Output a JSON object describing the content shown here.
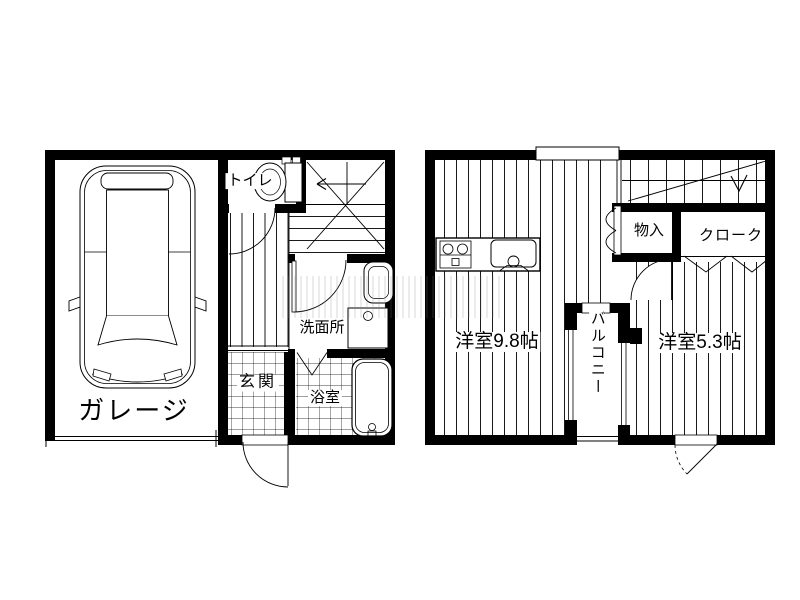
{
  "canvas": {
    "width": 800,
    "height": 600,
    "background": "#ffffff",
    "line_color": "#000000"
  },
  "floor1": {
    "rooms": {
      "garage": {
        "label": "ガレージ"
      },
      "toilet": {
        "label": "トイレ"
      },
      "washroom": {
        "label": "洗面所"
      },
      "entrance": {
        "label": "玄関"
      },
      "bathroom": {
        "label": "浴室"
      }
    },
    "fixtures": {
      "car": "car-top-view",
      "toilet_bowl": "toilet-icon",
      "washbasin": "washbasin-icon",
      "washing_machine": "washing-machine-icon",
      "bathtub": "bathtub-icon",
      "stairs": "staircase-with-winder"
    }
  },
  "floor2": {
    "rooms": {
      "room98": {
        "label": "洋室9.8帖",
        "tatami": 9.8
      },
      "room53": {
        "label": "洋室5.3帖",
        "tatami": 5.3
      },
      "balcony": {
        "label": "バルコニー"
      },
      "storage": {
        "label": "物入"
      },
      "cloak": {
        "label": "クローク"
      }
    },
    "fixtures": {
      "stove": "gas-stove-icon",
      "sink": "kitchen-sink-icon",
      "stairs": "straight-staircase"
    }
  }
}
